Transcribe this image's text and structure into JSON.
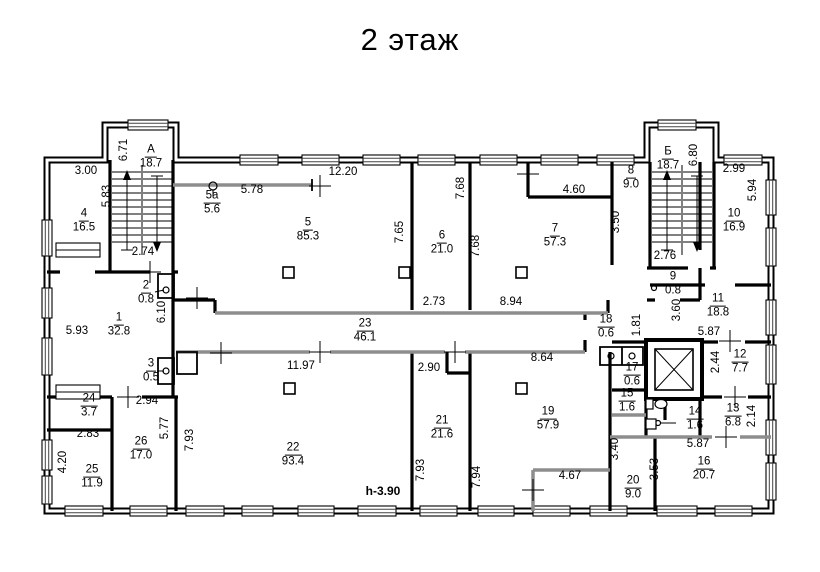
{
  "title": "2 этаж",
  "plan": {
    "stairs": [
      {
        "label": "А",
        "area": "18.7"
      },
      {
        "label": "Б",
        "area": "18.7"
      }
    ],
    "rooms": [
      {
        "number": "1",
        "area": "32.8"
      },
      {
        "number": "2",
        "area": "0.8"
      },
      {
        "number": "3",
        "area": "0.5"
      },
      {
        "number": "4",
        "area": "16.5"
      },
      {
        "number": "5",
        "area": "85.3"
      },
      {
        "number": "5а",
        "area": "5.6"
      },
      {
        "number": "6",
        "area": "21.0"
      },
      {
        "number": "7",
        "area": "57.3"
      },
      {
        "number": "8",
        "area": "9.0"
      },
      {
        "number": "9",
        "area": "0.8"
      },
      {
        "number": "10",
        "area": "16.9"
      },
      {
        "number": "11",
        "area": "18.8"
      },
      {
        "number": "12",
        "area": "7.7"
      },
      {
        "number": "13",
        "area": "6.8"
      },
      {
        "number": "14",
        "area": "1.6"
      },
      {
        "number": "15",
        "area": "1.6"
      },
      {
        "number": "16",
        "area": "20.7"
      },
      {
        "number": "17",
        "area": "0.6"
      },
      {
        "number": "18",
        "area": "0.6"
      },
      {
        "number": "19",
        "area": "57.9"
      },
      {
        "number": "20",
        "area": "9.0"
      },
      {
        "number": "21",
        "area": "21.6"
      },
      {
        "number": "22",
        "area": "93.4"
      },
      {
        "number": "23",
        "area": "46.1"
      },
      {
        "number": "24",
        "area": "3.7"
      },
      {
        "number": "25",
        "area": "11.9"
      },
      {
        "number": "26",
        "area": "17.0"
      }
    ],
    "dims": [
      {
        "v": "3.00"
      },
      {
        "v": "6.71"
      },
      {
        "v": "5.83"
      },
      {
        "v": "5.78"
      },
      {
        "v": "12.20"
      },
      {
        "v": "7.65"
      },
      {
        "v": "7.68"
      },
      {
        "v": "7.68"
      },
      {
        "v": "4.60"
      },
      {
        "v": "3.50"
      },
      {
        "v": "6.80"
      },
      {
        "v": "2.99"
      },
      {
        "v": "5.94"
      },
      {
        "v": "2.74"
      },
      {
        "v": "2.76"
      },
      {
        "v": "2.73"
      },
      {
        "v": "8.94"
      },
      {
        "v": "6.10"
      },
      {
        "v": "5.93"
      },
      {
        "v": "3.60"
      },
      {
        "v": "1.81"
      },
      {
        "v": "5.87"
      },
      {
        "v": "2.44"
      },
      {
        "v": "2.94"
      },
      {
        "v": "2.83"
      },
      {
        "v": "4.20"
      },
      {
        "v": "5.77"
      },
      {
        "v": "7.93"
      },
      {
        "v": "11.97"
      },
      {
        "v": "2.90"
      },
      {
        "v": "8.64"
      },
      {
        "v": "7.93"
      },
      {
        "v": "7.94"
      },
      {
        "v": "4.67"
      },
      {
        "v": "3.40"
      },
      {
        "v": "3.53"
      },
      {
        "v": "5.87"
      },
      {
        "v": "2.14"
      }
    ],
    "note": "h-3.90"
  }
}
